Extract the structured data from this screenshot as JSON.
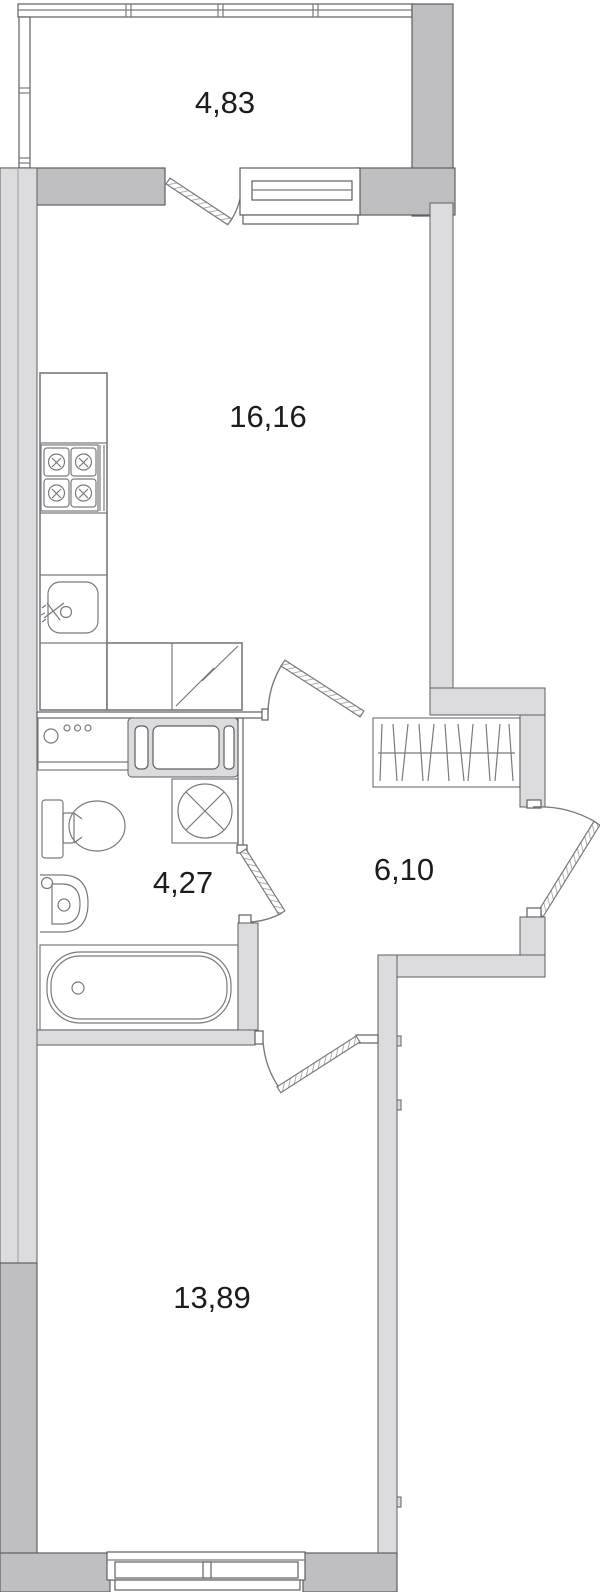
{
  "plan": {
    "title": "apartment-floor-plan",
    "rooms": [
      {
        "id": "balcony",
        "area": "4,83"
      },
      {
        "id": "kitchen-living",
        "area": "16,16"
      },
      {
        "id": "bathroom",
        "area": "4,27"
      },
      {
        "id": "hallway",
        "area": "6,10"
      },
      {
        "id": "bedroom",
        "area": "13,89"
      }
    ],
    "fixtures": [
      "stove-4-burner-icon",
      "kitchen-sink-icon",
      "refrigerator-icon",
      "kitchen-counter-icon",
      "cabinet-with-controls-icon",
      "built-in-unit-icon",
      "washing-machine-icon",
      "toilet-icon",
      "washbasin-icon",
      "bathtub-icon",
      "wardrobe-hanger-rail-icon",
      "window-icon",
      "door-swing-icon",
      "entrance-door-icon"
    ],
    "colors": {
      "wall_dark": "#bfbfc2",
      "wall_light": "#dcdcde",
      "line": "#5f5f63",
      "fixture": "#7a7a7e",
      "text": "#1c1c1e",
      "background": "#ffffff"
    }
  }
}
